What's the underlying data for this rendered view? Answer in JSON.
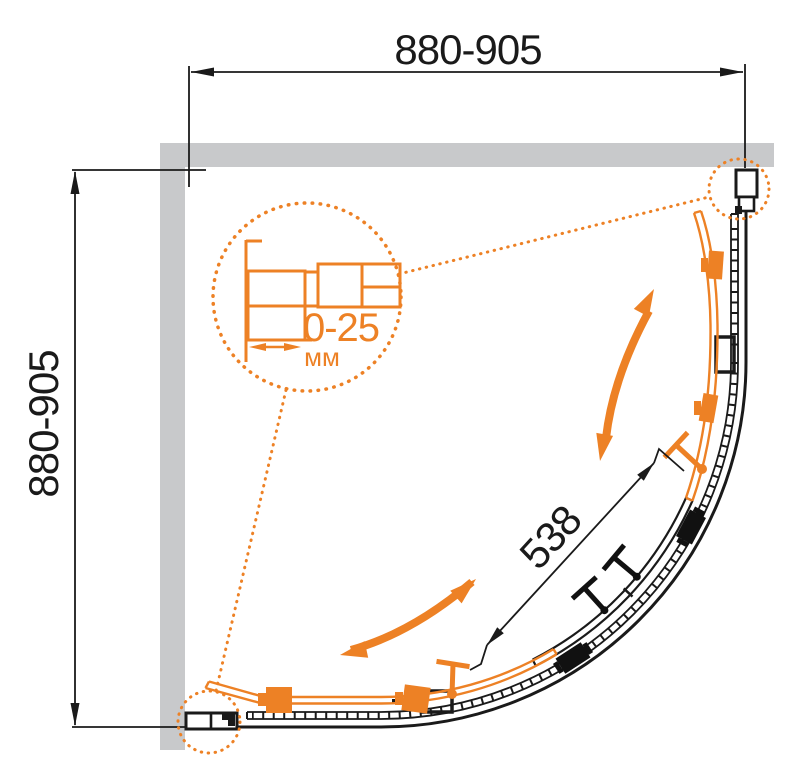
{
  "diagram": {
    "title": "quadrant-shower-enclosure-plan-view",
    "dimensions": {
      "width": "880-905",
      "depth": "880-905",
      "door_opening": "538",
      "profile_adjustment": "0-25",
      "adjustment_unit": "мм"
    },
    "colors": {
      "accent_orange": "#ED8125",
      "wall_gray": "#C8C9CB",
      "line_black": "#1A1A1A"
    }
  }
}
